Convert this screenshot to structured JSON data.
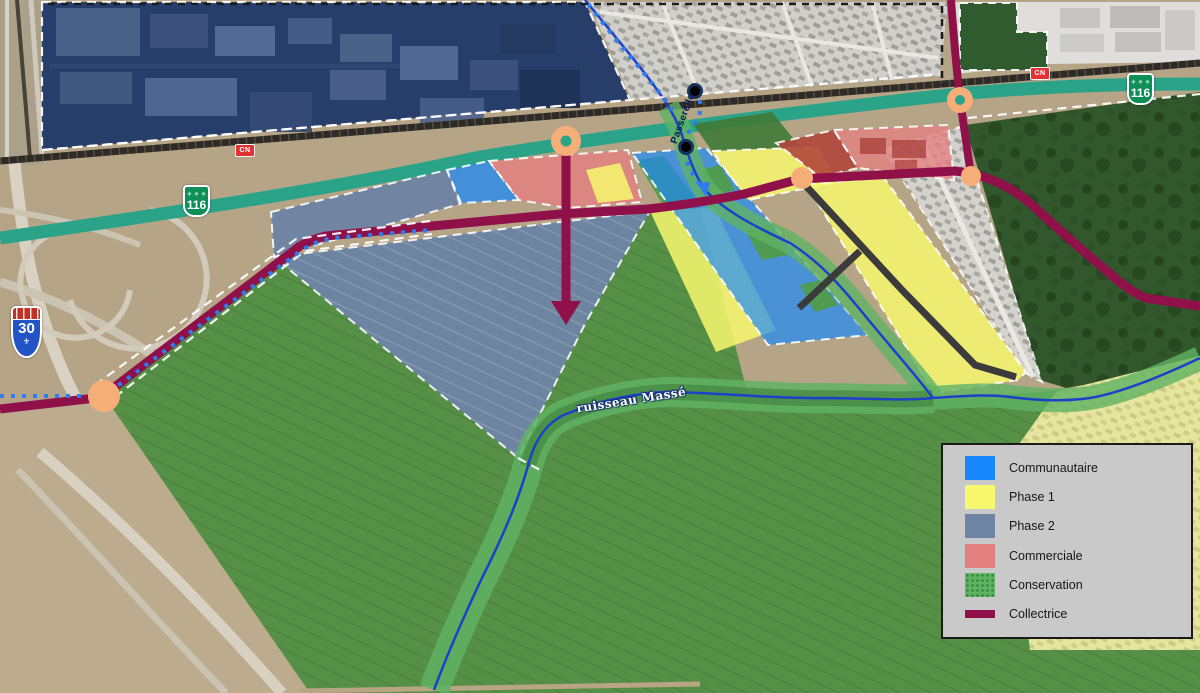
{
  "colors": {
    "communautaire": "#1787FB",
    "phase1": "#F8F86E",
    "phase2": "#6E84A4",
    "commerciale": "#E38181",
    "conservation": "#5FB364",
    "collectrice": "#90104A",
    "route_verte": "#2BA389",
    "shield116_green": "#0E8F58",
    "autoroute_blue": "#2254C5",
    "cn_red": "#E03434",
    "node_orange": "#F6AE78",
    "stream_blue": "#1C41C9",
    "path_dotted_blue": "#2F7BF0",
    "future_road_gray": "#3B3B3B"
  },
  "legend": {
    "items": [
      {
        "label": "Communautaire",
        "color": "#1787FB",
        "style": "fill"
      },
      {
        "label": "Phase 1",
        "color": "#F8F86E",
        "style": "fill"
      },
      {
        "label": "Phase 2",
        "color": "#6E84A4",
        "style": "fill"
      },
      {
        "label": "Commerciale",
        "color": "#E38181",
        "style": "fill"
      },
      {
        "label": "Conservation",
        "color": "#5FB364",
        "style": "fill-dotted"
      },
      {
        "label": "Collectrice",
        "color": "#90104A",
        "style": "line"
      }
    ]
  },
  "labels": {
    "stream": "ruisseau Massé",
    "passerelle": "Passerelle"
  },
  "shields": {
    "route116": "116",
    "route30": "30",
    "rail": "CN",
    "fleur_row": "⚜ ⚜ ⚜",
    "fleur": "⚜"
  }
}
